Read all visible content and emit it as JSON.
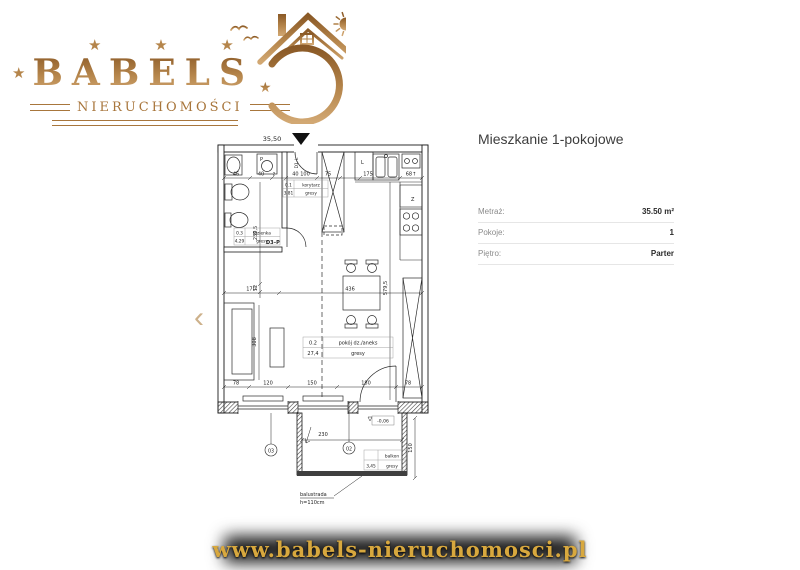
{
  "logo": {
    "stars": "★ ★ ★",
    "star": "★",
    "name": "BABELS",
    "subtitle": "NIERUCHOMOŚCI"
  },
  "nav": {
    "prev": "‹"
  },
  "details": {
    "title": "Mieszkanie 1-pokojowe",
    "rows": [
      {
        "label": "Metraż:",
        "value": "35.50 m²"
      },
      {
        "label": "Pokoje:",
        "value": "1"
      },
      {
        "label": "Piętro:",
        "value": "Parter"
      }
    ]
  },
  "plan": {
    "area": "35,50",
    "d1": "D1–L",
    "d3": "D3–P",
    "p": "P",
    "l": "L",
    "z": "Z",
    "t46": "46",
    "t40": "40",
    "t2": "2",
    "t40100": "40 100",
    "t75": "75",
    "t175": "175",
    "t68": "68↑",
    "v2395": "239,5",
    "v12": "12",
    "t170": "170",
    "t436": "436",
    "v5795": "579,5",
    "v308": "308",
    "b78a": "78",
    "b120": "120",
    "b150": "150",
    "b180": "180",
    "b78b": "78",
    "bal230": "230",
    "bal150": "150",
    "level": "-0,06",
    "o02": "02",
    "o03": "03",
    "hall_no": "0.1",
    "hall_name": "korytarz",
    "hall_area": "3,81",
    "hall_fl": "gresy",
    "bath_no": "0.3",
    "bath_name": "łazienka",
    "bath_area": "4,29",
    "bath_fl": "gresy",
    "room_no": "0.2",
    "room_name": "pokój dz./aneks",
    "room_area": "27,4",
    "room_fl": "gresy",
    "balk_name": "balkon",
    "balk_area": "3,45",
    "balk_fl": "gresy",
    "balu1": "balustrada",
    "balu2": "h=110cm"
  },
  "footer": {
    "url": "www.babels-nieruchomosci.pl"
  },
  "colors": {
    "logo_gold": "#a9763b",
    "banner_gold": "#d8a83e",
    "plan_line": "#222222",
    "banner_bg": "#1d1d1d"
  }
}
